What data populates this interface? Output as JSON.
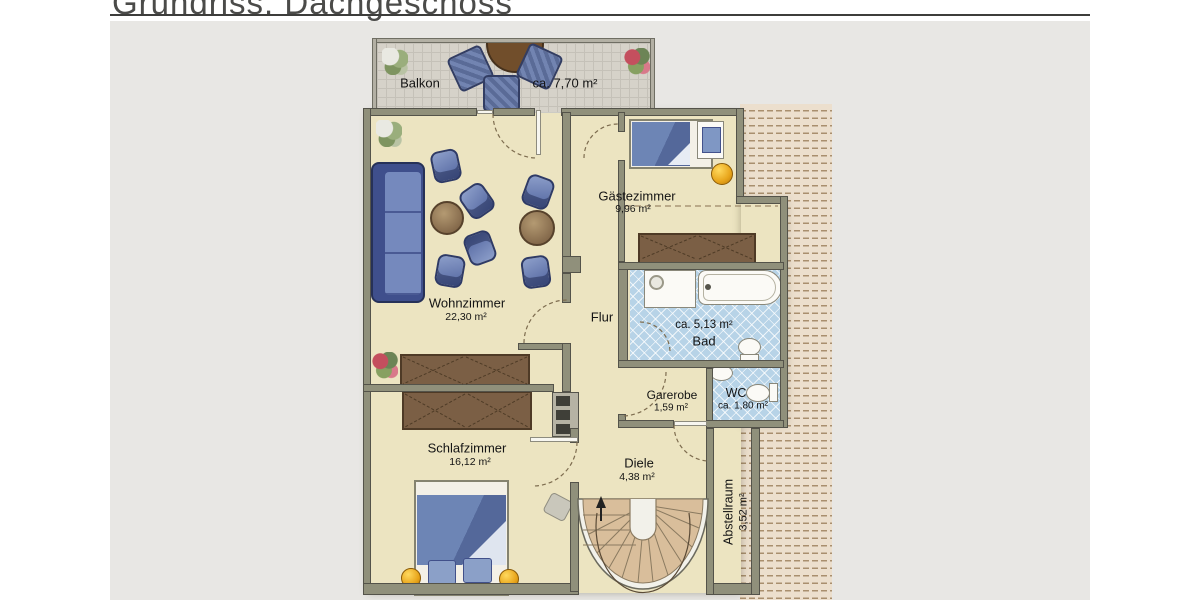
{
  "title": "Grundriss: Dachgeschoss",
  "floor_plan": {
    "rooms": {
      "balkon": {
        "name": "Balkon",
        "area": "ca. 7,70 m²"
      },
      "wohnzimmer": {
        "name": "Wohnzimmer",
        "area": "22,30 m²"
      },
      "gaestezimmer": {
        "name": "Gästezimmer",
        "area": "9,96 m²"
      },
      "flur": {
        "name": "Flur"
      },
      "bad": {
        "name": "Bad",
        "area": "ca. 5,13 m²"
      },
      "garderobe": {
        "name": "Garerobe",
        "area": "1,59 m²"
      },
      "wc": {
        "name": "WC",
        "area": "ca. 1,80 m²"
      },
      "schlafzimmer": {
        "name": "Schlafzimmer",
        "area": "16,12 m²"
      },
      "diele": {
        "name": "Diele",
        "area": "4,38 m²"
      },
      "abstellraum": {
        "name": "Abstellraum",
        "area": "3,52 m²"
      }
    },
    "colors": {
      "floor_cream": "#ece4c1",
      "wall_gray": "#90907b",
      "bath_tile_blue": "#b7d3e7",
      "furniture_blue": "#5e76ac",
      "wood_brown": "#7b5f45",
      "accent_yellow": "#e8a51b",
      "roof_hatch": "#ecdfcd",
      "stairs_tan": "#d9be9b",
      "background_gray": "#e8e7e4"
    }
  }
}
